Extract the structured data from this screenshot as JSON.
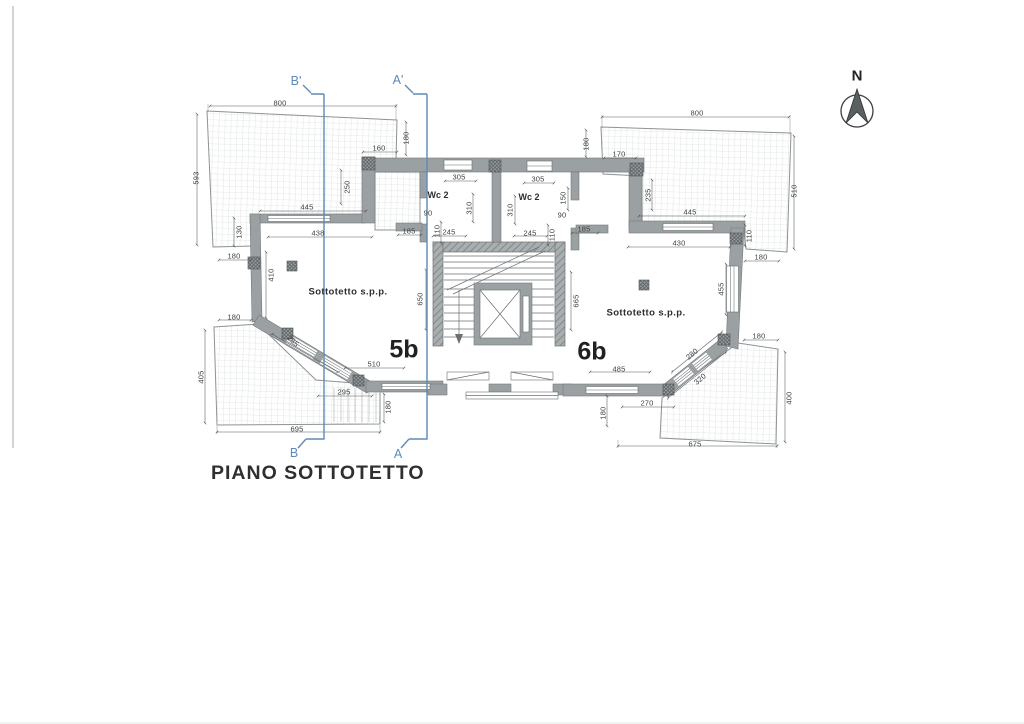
{
  "title": "PIANO SOTTOTETTO",
  "north": {
    "label": "N"
  },
  "sections": {
    "b_prime": "B'",
    "a_prime": "A'",
    "b": "B",
    "a": "A"
  },
  "units": [
    {
      "label": "5b",
      "room": "Sottotetto s.p.p.",
      "wc": "Wc 2"
    },
    {
      "label": "6b",
      "room": "Sottotetto s.p.p.",
      "wc": "Wc 2"
    }
  ],
  "dims": [
    "800",
    "593",
    "160",
    "180",
    "250",
    "445",
    "438",
    "130",
    "180",
    "410",
    "180",
    "405",
    "285",
    "295",
    "180",
    "695",
    "510",
    "650",
    "305",
    "310",
    "245",
    "110",
    "90",
    "185",
    "305",
    "310",
    "245",
    "110",
    "150",
    "90",
    "185",
    "170",
    "180",
    "235",
    "800",
    "510",
    "445",
    "430",
    "110",
    "180",
    "455",
    "180",
    "665",
    "485",
    "280",
    "320",
    "270",
    "180",
    "675",
    "400"
  ],
  "colors": {
    "paper": "#ffffff",
    "wall": "#9ba1a3",
    "wall_hatch": "#7d8385",
    "terrace_grid": "#c9cdcc",
    "dimension_text": "#3f4142",
    "section_line": "#5d8ab8",
    "title_text": "#2e2f30",
    "north_arrow": "#5a5f61"
  }
}
